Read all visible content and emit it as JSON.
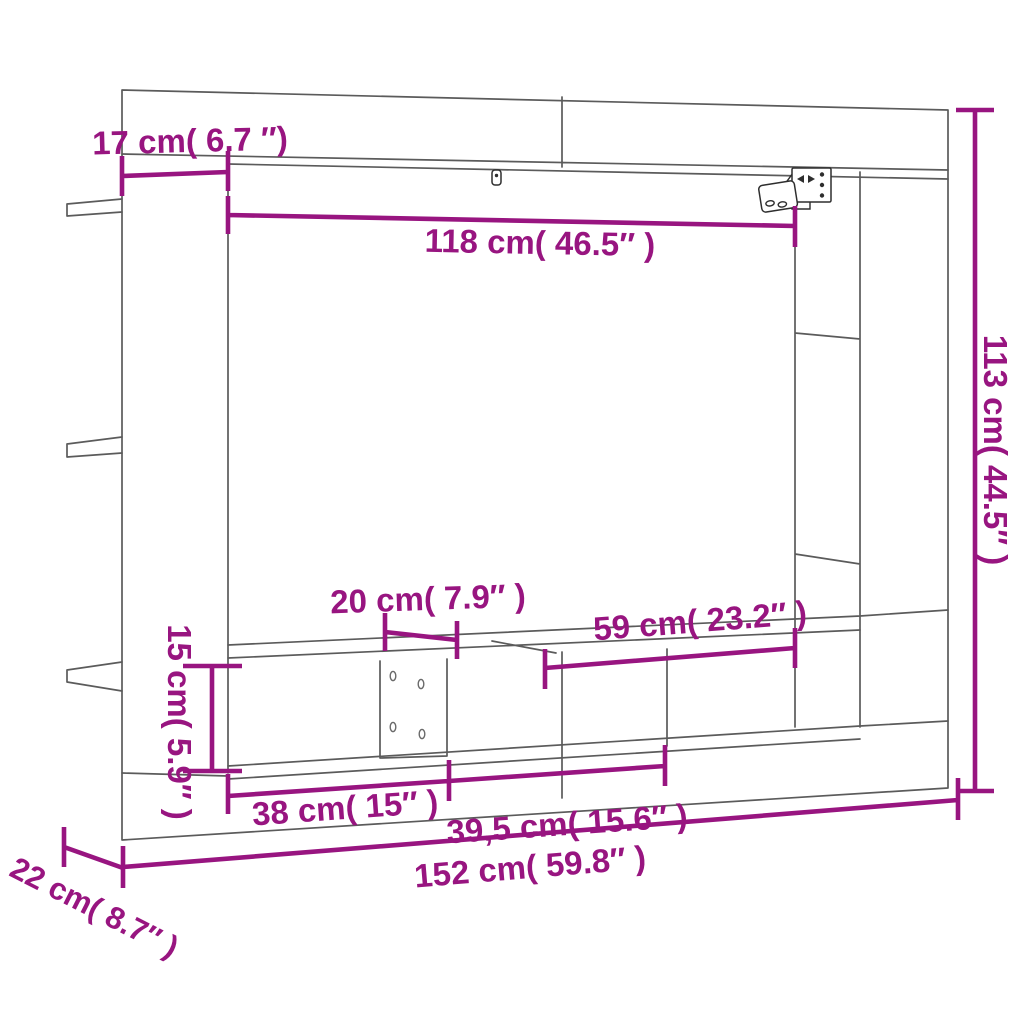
{
  "diagram": {
    "title": "TV wall unit dimension diagram",
    "accent_color": "#981580",
    "line_color": "#5b5b5b",
    "dimensions": {
      "top_left_depth": {
        "label": "17 cm( 6.7 ″)",
        "cm": "17",
        "inches": "6.7"
      },
      "opening_width": {
        "label": "118 cm( 46.5″ )",
        "cm": "118",
        "inches": "46.5"
      },
      "total_height": {
        "label": "113 cm( 44.5″ )",
        "cm": "113",
        "inches": "44.5"
      },
      "divider_width": {
        "label": "20 cm( 7.9″ )",
        "cm": "20",
        "inches": "7.9"
      },
      "right_compartment_width": {
        "label": "59 cm( 23.2″ )",
        "cm": "59",
        "inches": "23.2"
      },
      "bench_height": {
        "label": "15 cm( 5.9″ )",
        "cm": "15",
        "inches": "5.9"
      },
      "left_compartment_width": {
        "label": "38 cm( 15″ )",
        "cm": "38",
        "inches": "15"
      },
      "middle_compartment_width": {
        "label": "39,5 cm( 15.6″ )",
        "cm": "39,5",
        "inches": "15.6"
      },
      "total_width": {
        "label": "152 cm( 59.8″ )",
        "cm": "152",
        "inches": "59.8"
      },
      "total_depth": {
        "label": "22 cm( 8.7″ )",
        "cm": "22",
        "inches": "8.7"
      }
    }
  }
}
